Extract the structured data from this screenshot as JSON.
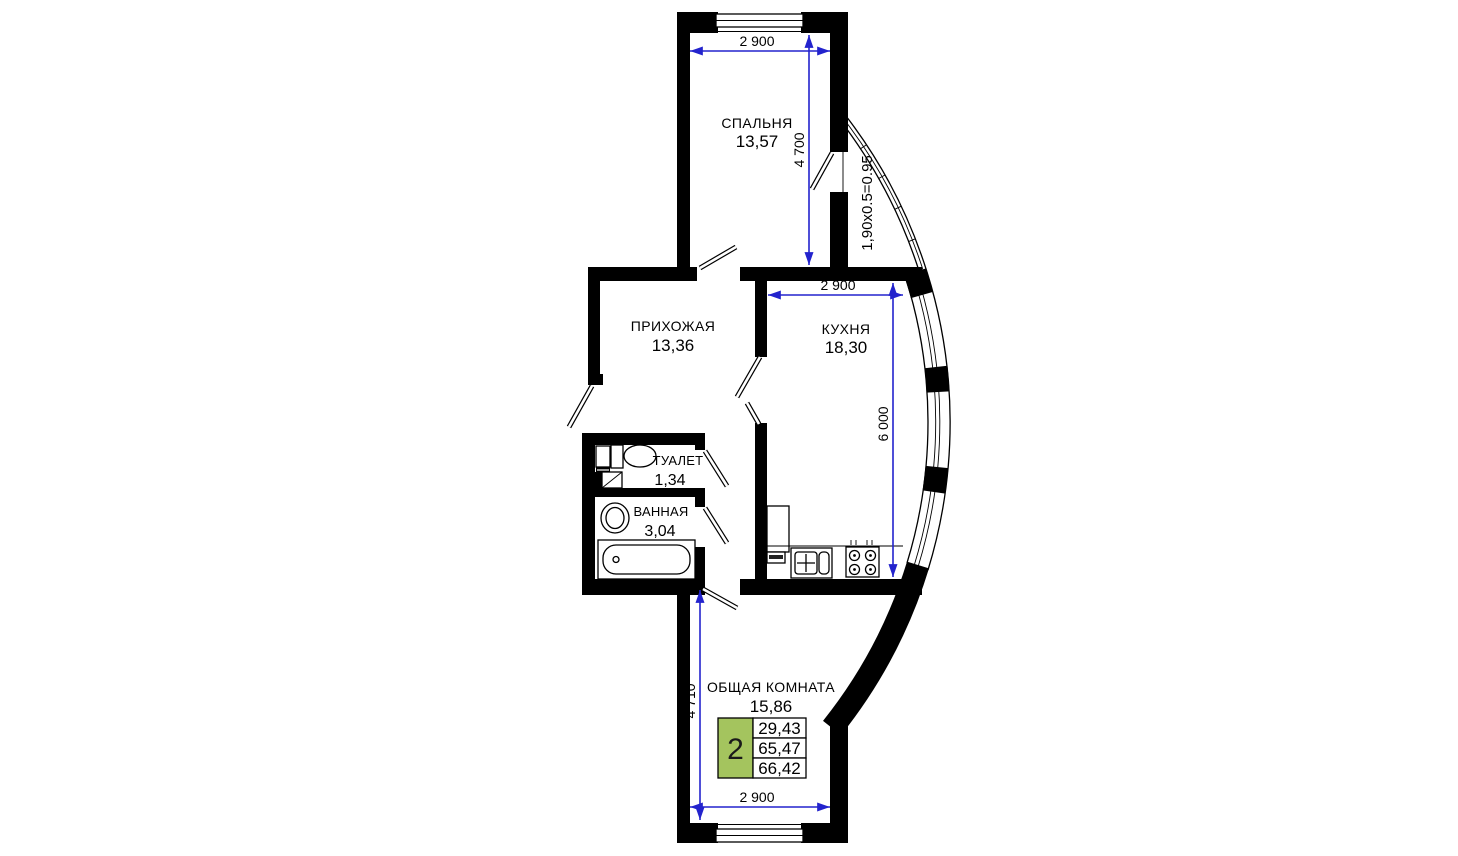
{
  "plan": {
    "type": "apartment-floor-plan",
    "colors": {
      "wall": "#000000",
      "dimension_line": "#2323cd",
      "summary_green": "#a4c45e"
    }
  },
  "rooms": [
    {
      "key": "bedroom",
      "name": "СПАЛЬНЯ",
      "area": "13,57"
    },
    {
      "key": "hallway",
      "name": "ПРИХОЖАЯ",
      "area": "13,36"
    },
    {
      "key": "kitchen",
      "name": "КУХНЯ",
      "area": "18,30"
    },
    {
      "key": "toilet",
      "name": "ТУАЛЕТ",
      "area": "1,34"
    },
    {
      "key": "bathroom",
      "name": "ВАННАЯ",
      "area": "3,04"
    },
    {
      "key": "living_room",
      "name": "ОБЩАЯ КОМНАТА",
      "area": "15,86"
    }
  ],
  "dimensions": {
    "bedroom_width": "2 900",
    "bedroom_depth": "4 700",
    "kitchen_width": "2 900",
    "kitchen_depth": "6 000",
    "living_depth": "4 710",
    "living_width": "2 900",
    "balcony_formula": "1,90x0.5=0.95"
  },
  "summary": {
    "rooms_count": "2",
    "living_area": "29,43",
    "area_without_balcony": "65,47",
    "total_area": "66,42"
  }
}
